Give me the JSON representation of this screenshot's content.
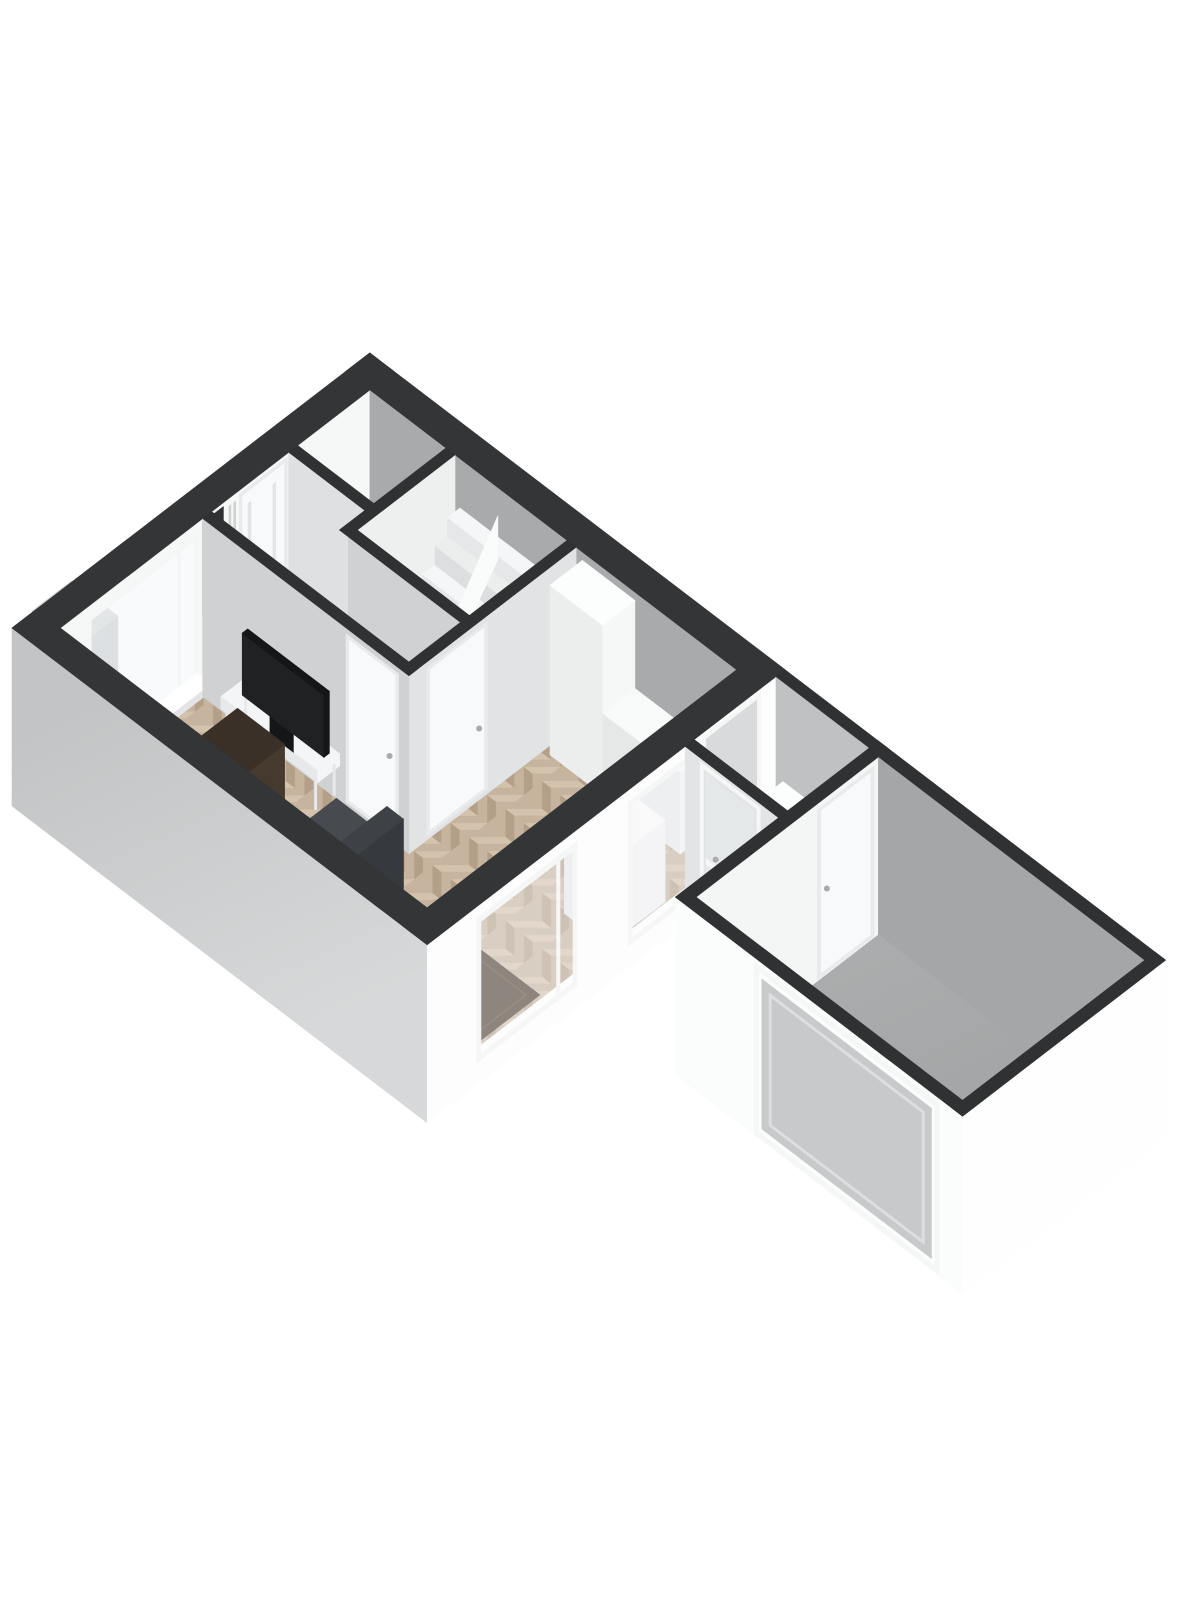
{
  "meta": {
    "kind": "3d-floorplan-render",
    "view": "axonometric",
    "background": "#ffffff"
  },
  "palette": {
    "bg": "#ffffff",
    "capThick": "#333537",
    "capThin": "#2f3132",
    "extGrayTop": "#c2c4c5",
    "extGrayBot": "#d7d8d9",
    "extWhite": "#fdfdfe",
    "extWhiteShade": "#f3f4f4",
    "nwInterior": "#f6f7f7",
    "neInterior": "#a8aaab",
    "partitionFace": "#cfd1d2",
    "wallCface": "#e2e3e4",
    "wallEface": "#eef0f0",
    "toiletWall": "#dfe0e1",
    "porchNEface": "#bfc1c2",
    "garageNWface": "#f4f5f5",
    "garageNEface": "#a4a6a7",
    "garageSWface": "#fbfcfc",
    "garageSEface": "#fefefe",
    "garageDoorPanel": "#c7c9ca",
    "woodBase": "#c6b49f",
    "woodDark": "#b4a089",
    "woodLight": "#d4c4ae",
    "stairFloor": "#e6e7e7",
    "toiletFloor": "#d8d9d9",
    "porchFloor": "#d8d9d9",
    "garFloorA": "#b4b6b7",
    "garFloorB": "#a0a2a3",
    "rug": "#4c3e31",
    "rugEdge": "#5b4b3b",
    "deskTop": "#3a3027",
    "deskSide": "#2b231c",
    "deskFront": "#453a2d",
    "sofaTop": "#3e4246",
    "sofaSide": "#2c2f32",
    "sofaFront": "#363a3e",
    "sofaSeat": "#474b50",
    "chair": "#dbd2c3",
    "chairShade": "#c9c0b1",
    "chairFront": "#e3dbcd",
    "consoleWhite": "#f4f5f6",
    "consoleShade": "#e7e8e9",
    "tv": "#1f2123",
    "tvDark": "#141617",
    "counterTop": "#f8f9f9",
    "counterSide": "#e6e8e8",
    "counterFront": "#f0f1f2",
    "cabinetSide": "#eceeee",
    "cabinetFront": "#f6f7f7",
    "cabinetTop": "#fcfdfd",
    "stairTopA": "#f5f6f7",
    "stairTopB": "#eceded",
    "riserA": "#e6e7e8",
    "riserB": "#dddedf",
    "banister": "#f0f1f2",
    "banister2": "#fafbfb",
    "frame": "#f5f6f6",
    "frameShade": "#e3e4e5",
    "sill": "#ffffff",
    "glass": "rgba(242,246,247,0.5)",
    "glassLight": "rgba(250,251,252,0.38)",
    "doorPanel": "#f8f9fa",
    "doorFrame": "#e9eaeb",
    "doorwayFill": "#d9dadb",
    "niche": "#2e3032",
    "red": "#a83636",
    "handle": "#a9abac",
    "cubeSW": "#b5b7b8",
    "cubeSE": "#c9cbcc",
    "cubeTop": "#d5d7d7",
    "darkBox": "#3b3d3f"
  },
  "scene": {
    "rooms": [
      {
        "name": "living-room",
        "floor": "herringbone-wood"
      },
      {
        "name": "hall",
        "floor": "herringbone-wood"
      },
      {
        "name": "stair-closet",
        "floor": "light"
      },
      {
        "name": "toilet",
        "floor": "light"
      },
      {
        "name": "kitchen-area",
        "floor": "herringbone-wood"
      },
      {
        "name": "porch",
        "floor": "gray"
      },
      {
        "name": "garage",
        "floor": "concrete"
      }
    ],
    "furniture": [
      "tv",
      "tv-console",
      "desk-l-shape",
      "sofa",
      "rug",
      "armchair",
      "kitchen-island",
      "kitchen-tall-cabinet",
      "kitchen-counter",
      "winder-stairs",
      "meter-cupboard",
      "faucet",
      "porch-cabinet",
      "wall-box"
    ],
    "openings": [
      "front-door",
      "hall-door",
      "stair-door",
      "kitchen-porch-doorway",
      "back-door-glazed",
      "garage-entry-door",
      "garage-overhead-door",
      "window-nw",
      "window-front-large",
      "window-front-small"
    ]
  }
}
